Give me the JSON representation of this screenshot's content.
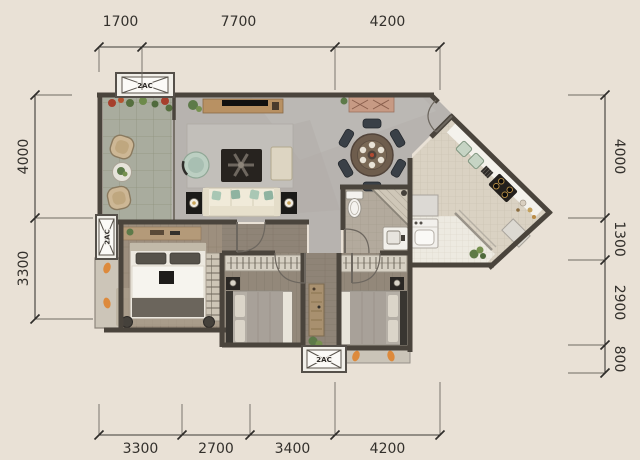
{
  "dimensions": {
    "top": [
      "1700",
      "7700",
      "4200"
    ],
    "bottom": [
      "3300",
      "2700",
      "3400",
      "4200"
    ],
    "left": [
      "4000",
      "3300"
    ],
    "right": [
      "4000",
      "1300",
      "2900",
      "800"
    ]
  },
  "labels": {
    "ac_top": "2AC",
    "ac_left": "2AC",
    "ac_bottom": "2AC"
  },
  "colors": {
    "background": "#e9e1d6",
    "wall": "#4a443c",
    "dimension_text": "#33302c",
    "living_floor_marble": "#b7b3af",
    "balcony_tile": "#a9ac9e",
    "bedroom_wood": "#9d8f7e",
    "bathroom_tile": "#b3aa9d",
    "kitchen_tile": "#dad2c3",
    "counter_white": "#f4f2ec",
    "sink_green": "#c6d4c4",
    "sofa_cream": "#f0ead9",
    "pillow_green": "#a9c7b4",
    "accent_orange": "#dd8a3c",
    "dark_furniture": "#211e1c"
  }
}
